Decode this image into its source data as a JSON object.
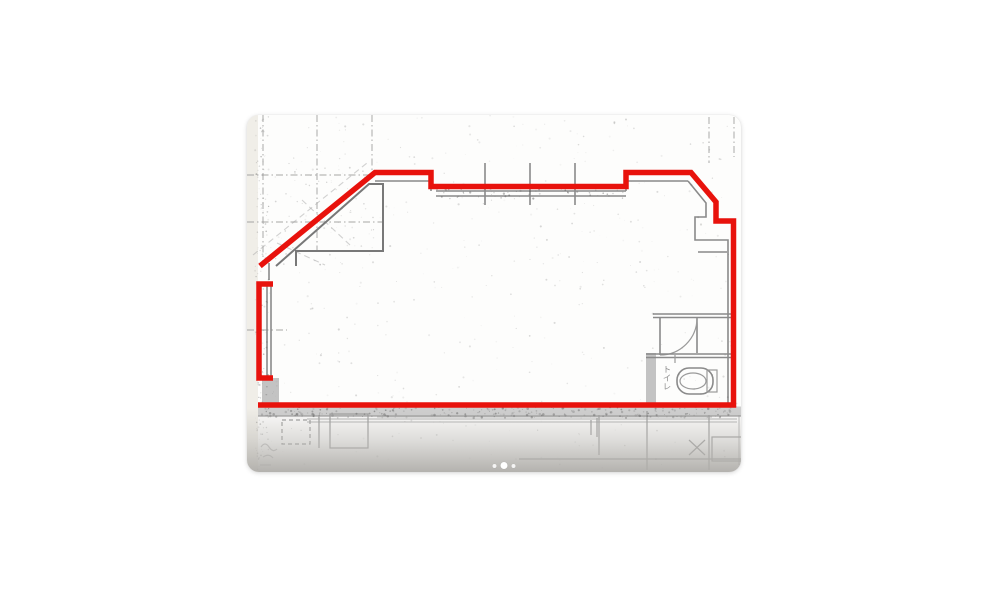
{
  "page": {
    "background": "#ffffff"
  },
  "floorplan": {
    "outline_color": "#e8120c",
    "drawing_line_color": "#8a8a8a",
    "labels": {
      "toilet": "トイレ"
    }
  },
  "carousel": {
    "dots": [
      {
        "active": false
      },
      {
        "active": true
      },
      {
        "active": false
      }
    ]
  }
}
